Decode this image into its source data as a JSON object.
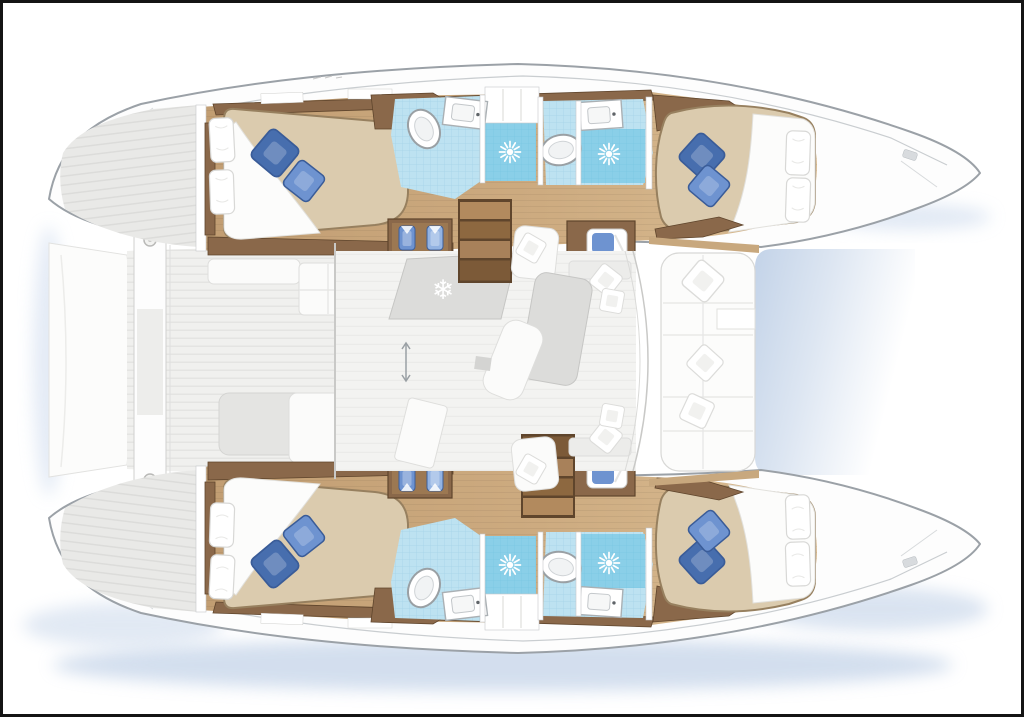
{
  "figure": {
    "kind": "yacht-floor-plan",
    "description_visible_text": ""
  },
  "icons": {
    "fridge": "❄"
  },
  "colors": {
    "frame": "#141414",
    "paper": "#ffffff",
    "hull_fill": "#fdfdfd",
    "hull_stroke": "#9ba1a7",
    "gunwale": "#c9cdd0",
    "shadow": "#b6c9e3",
    "stern_deck": "#e9e9e7",
    "stern_deck_line": "#dcdcda",
    "deck_plank_light": "#f0f0ee",
    "deck_plank_dark": "#e4e4e2",
    "salon_floor": "#f3f3f1",
    "salon_floor_line": "#ebebe9",
    "wood": "#c9a77d",
    "wood_light": "#d8bb92",
    "wood_dark": "#8a684a",
    "wood_edge": "#5f452c",
    "step_light": "#b28a5e",
    "step_mid": "#a8815a",
    "step_dark": "#7c5a38",
    "step_deep": "#8d6840",
    "tile": "#bde2f1",
    "tile_grid": "#9ecfe4",
    "shower": "#8acfe8",
    "shower_grid": "#74c3e0",
    "fixture": "#ffffff",
    "fixture_stroke": "#9aa0a4",
    "bed": "#dbcbae",
    "bed_stroke": "#97805f",
    "sheet": "#fcfcfb",
    "pillow_stroke": "#d8d8d6",
    "pillow_blue": "#6e93d0",
    "pillow_blue_dark": "#476eae",
    "pillow_blue_light": "#93b3e2",
    "furniture_gray": "#dcdcda",
    "furniture_stroke": "#c6c6c4",
    "pad_gray": "#e4e4e2",
    "trampoline_blue": "#c3d3e8",
    "caprail": "#c8a87e"
  }
}
